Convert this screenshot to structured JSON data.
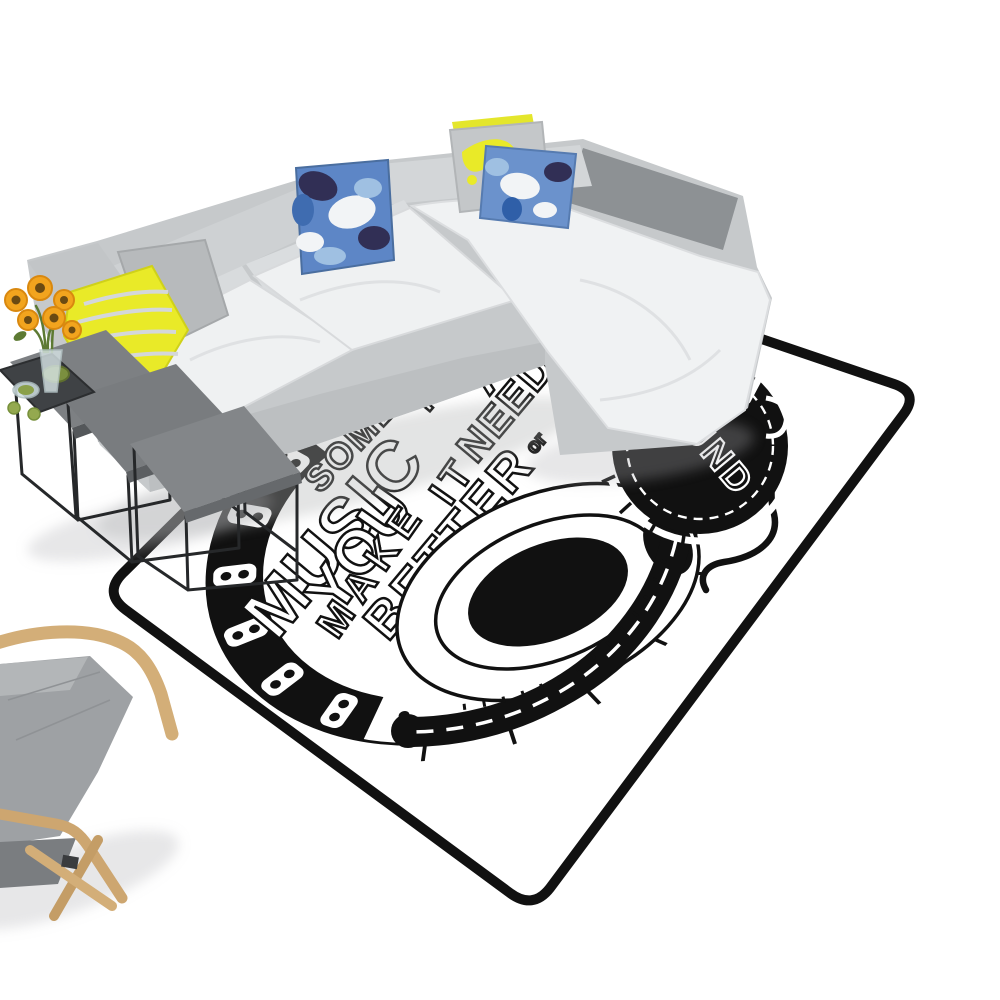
{
  "meta": {
    "description": "Product photo: black and white music themed area rug in a white room with a light gray sectional sofa, patterned pillows, metal nesting side tables with sunflowers, and a wood frame armchair",
    "background": "#ffffff"
  },
  "rug": {
    "words": {
      "sometimes": "SOMETIMES",
      "music": "MUSIC",
      "is": "IS",
      "all": "ALL",
      "you": "YOU",
      "need": "NEED",
      "or": "or",
      "feel": "FEE",
      "make": "MAKE",
      "it": "IT",
      "better": "BETTER",
      "sound": "SOUND"
    }
  },
  "colors": {
    "rug_base": "#ffffff",
    "ink": "#111111",
    "sofa_body": "#c6c9cb",
    "sofa_seat": "#eff1f2",
    "sofa_back_cushion": "#d8dbdd",
    "chaise_back": "#8d9194",
    "pillow_blue": "#5d86c6",
    "pillow_blue_2": "#6b92cc",
    "pillow_navy": "#312f55",
    "pillow_yellow": "#e9ea28",
    "pillow_gray": "#b7babc",
    "table_top": "#7d8083",
    "metal": "#26282a",
    "wood": "#d3ae78",
    "chair_fabric": "#9ea1a4",
    "sunflower_petal": "#f2a41e",
    "sunflower_center": "#6b4a12",
    "leaf": "#5d7a33",
    "bowl_green": "#7b8f3f",
    "apple_green": "#94a94f"
  }
}
